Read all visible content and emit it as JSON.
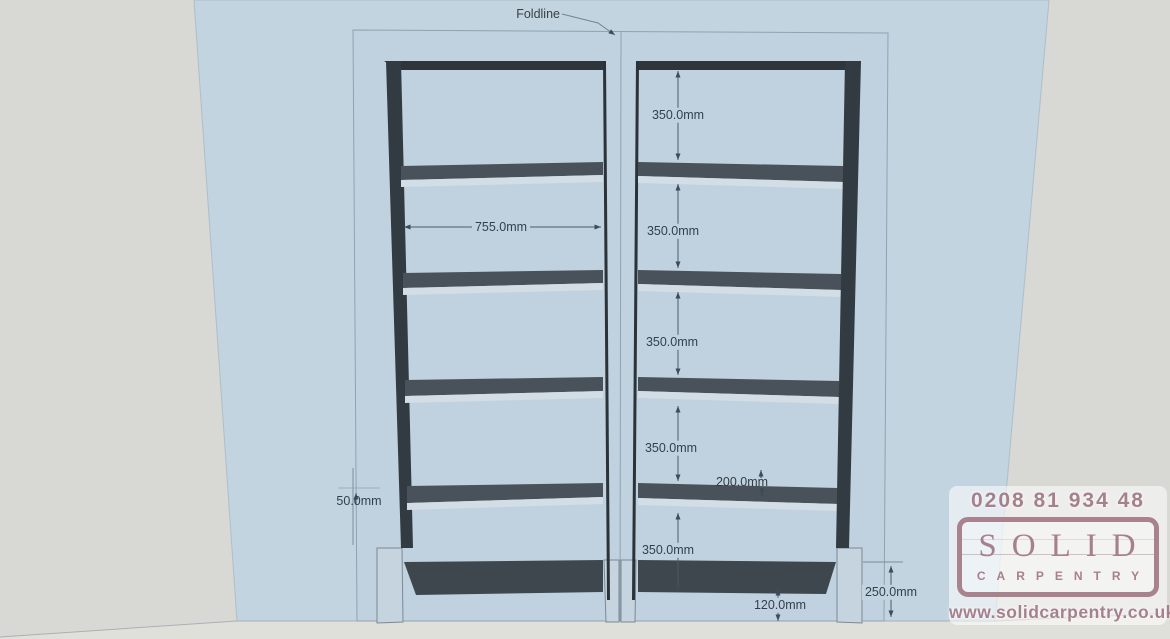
{
  "drawing": {
    "foldline_label": "Foldline",
    "gap_labels": [
      "350.0mm",
      "350.0mm",
      "350.0mm",
      "350.0mm",
      "350.0mm"
    ],
    "interior_width_label": "755.0mm",
    "offset_label": "50.0mm",
    "depth_label": "200.0mm",
    "plinth_label": "120.0mm",
    "base_label": "250.0mm"
  },
  "branding": {
    "phone": "0208 81 934 48",
    "logo_word": "SOLID",
    "logo_word2": "CARPENTRY",
    "website": "www.solidcarpentry.co.uk",
    "brand_color": "#a5818d"
  },
  "colors": {
    "background": "#d8d8d4",
    "wall": "#c3d4e1",
    "alcove_panel": "#c0d2df",
    "floor": "#e0e0da",
    "frame_dark": "#2e353b",
    "shelf_dark": "#49525a",
    "shelf_light": "#d3dde5",
    "leg_light": "#c6d4e0",
    "dimension_line": "#4a5b6a"
  }
}
